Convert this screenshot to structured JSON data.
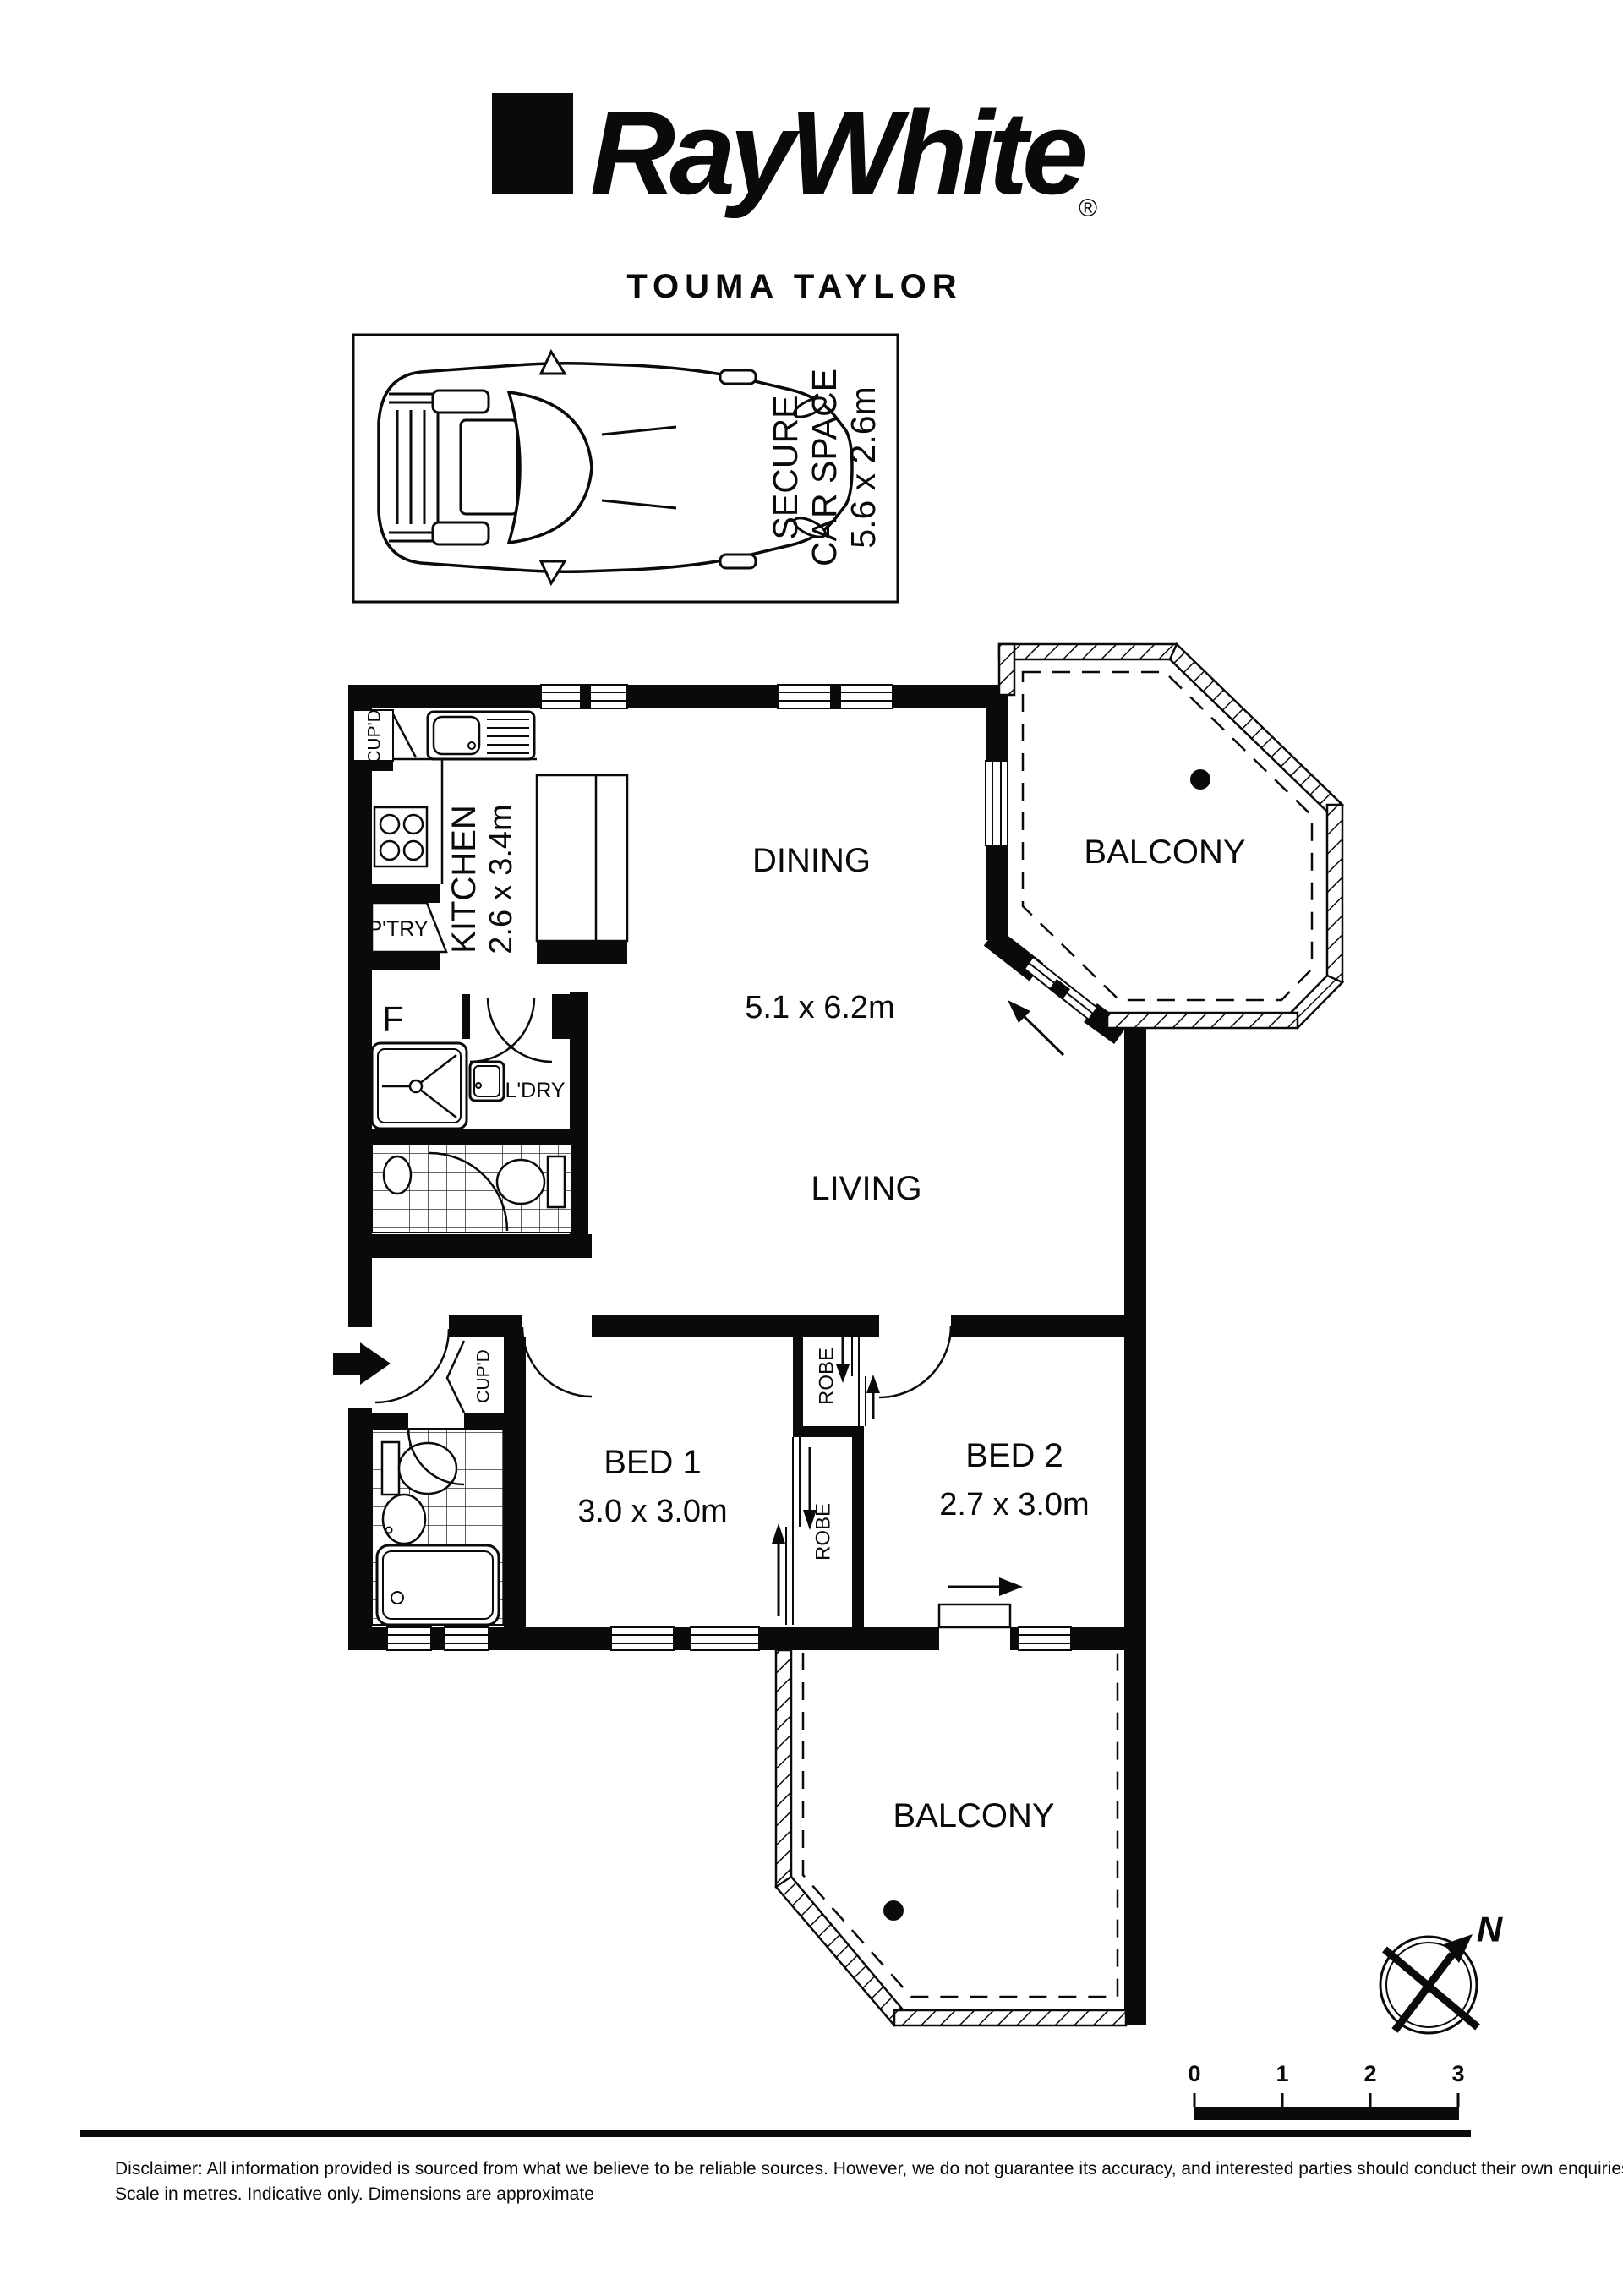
{
  "labels": {
    "brand": "RayWhite",
    "registered": "®",
    "agency": "TOUMA TAYLOR",
    "car_line1": "SECURE",
    "car_line2": "CAR SPACE",
    "car_dim": "5.6 x 2.6m",
    "kitchen": "KITCHEN",
    "kitchen_dim": "2.6 x 3.4m",
    "dining": "DINING",
    "living": "LIVING",
    "living_dim": "5.1 x 6.2m",
    "balcony_top": "BALCONY",
    "balcony_bottom": "BALCONY",
    "bed1": "BED 1",
    "bed1_dim": "3.0 x 3.0m",
    "bed2": "BED 2",
    "bed2_dim": "2.7 x 3.0m",
    "laundry": "L'DRY",
    "pantry": "P'TRY",
    "cupboard_kitchen": "CUP'D",
    "cupboard_entry": "CUP'D",
    "robe_1": "ROBE",
    "robe_2": "ROBE",
    "fridge": "F",
    "north": "N"
  },
  "scale_bar": {
    "labels": [
      "0",
      "1",
      "2",
      "3"
    ]
  },
  "disclaimer": {
    "line1": "Disclaimer: All information provided is sourced from what we believe to be reliable sources. However, we do not guarantee  its accuracy, and interested parties should conduct their own enquiries.",
    "line2": "Scale in metres. Indicative only. Dimensions are approximate"
  },
  "colors": {
    "ink": "#0a0a0a",
    "paper": "#ffffff"
  }
}
